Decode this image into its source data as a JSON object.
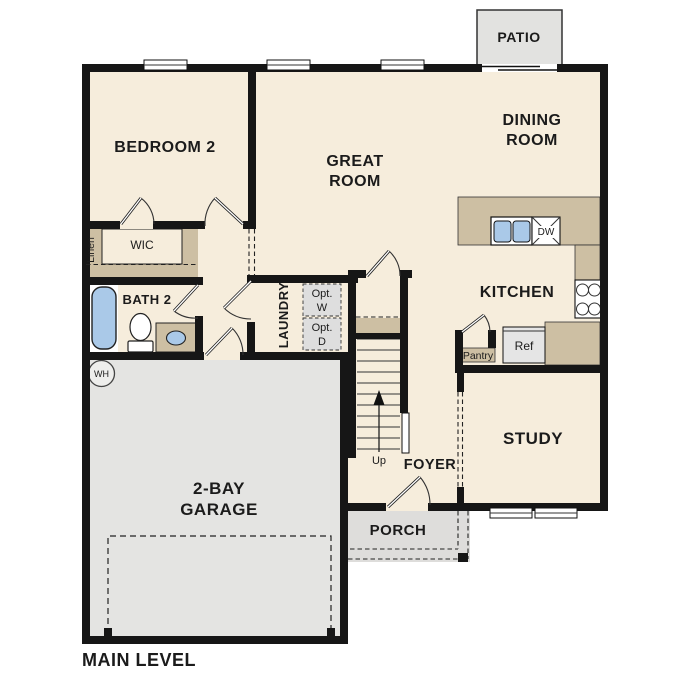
{
  "colors": {
    "wall": "#161616",
    "floor": "#f6eddc",
    "counter": "#cdbfa3",
    "garage": "#e4e4e2",
    "porch": "#dedddb",
    "patio": "#e2e2e0",
    "appliance": "#e5e5e5",
    "option_box": "#dedede",
    "fixture": "#aac9e8"
  },
  "plan": {
    "title": "MAIN LEVEL"
  },
  "rooms": {
    "bedroom2": {
      "label": "BEDROOM 2"
    },
    "great": {
      "lines": [
        "GREAT",
        "ROOM"
      ]
    },
    "dining": {
      "lines": [
        "DINING",
        "ROOM"
      ]
    },
    "kitchen": {
      "label": "KITCHEN"
    },
    "study": {
      "label": "STUDY"
    },
    "foyer": {
      "label": "FOYER"
    },
    "garage": {
      "lines": [
        "2-BAY",
        "GARAGE"
      ]
    },
    "porch": {
      "label": "PORCH"
    },
    "patio": {
      "label": "PATIO"
    },
    "bath2": {
      "label": "BATH 2"
    },
    "wic": {
      "label": "WIC"
    },
    "linen": {
      "label": "Linen"
    },
    "laundry": {
      "label": "LAUNDRY"
    }
  },
  "features": {
    "opt_washer": {
      "lines": [
        "Opt.",
        "W"
      ]
    },
    "opt_dryer": {
      "lines": [
        "Opt.",
        "D"
      ]
    },
    "pantry": {
      "label": "Pantry"
    },
    "fridge": {
      "label": "Ref"
    },
    "dishwasher": {
      "label": "DW"
    },
    "stairs": {
      "label": "Up"
    },
    "water_heater": {
      "label": "WH"
    }
  }
}
